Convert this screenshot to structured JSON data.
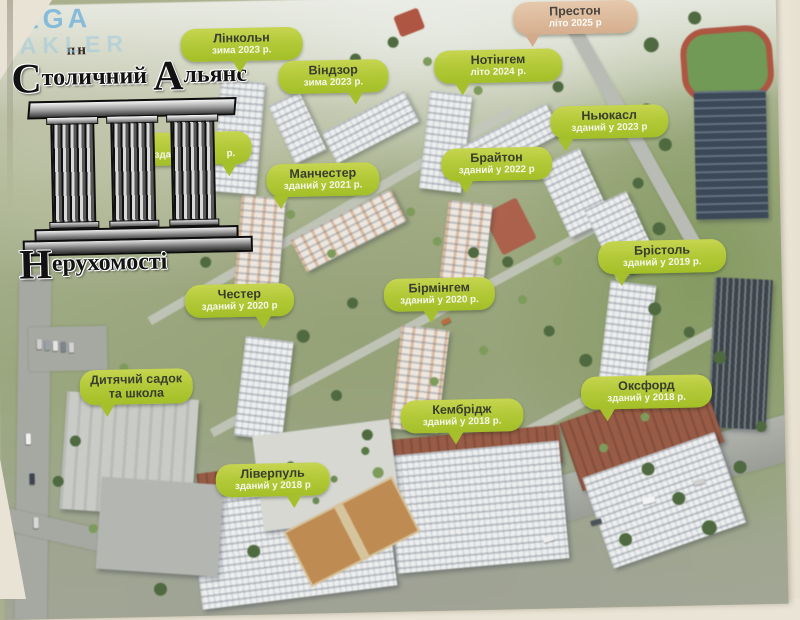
{
  "watermark": {
    "line1": "MEGA",
    "line2": "MAKLER"
  },
  "logo": {
    "top": "пн",
    "title_cap1": "С",
    "title_rest1": "толичний",
    "title_cap2": "А",
    "title_rest2": "льянс",
    "sub_cap": "Н",
    "sub_rest": "ерухомості"
  },
  "labels": [
    {
      "id": "london-partial",
      "title": "Ло",
      "date": "здани                р.",
      "variant": "green",
      "x": 143,
      "y": 130,
      "w": 102,
      "tail": 80,
      "behind_logo": true
    },
    {
      "id": "linkoln",
      "title": "Лінкольн",
      "date": "зима 2023 р.",
      "variant": "green",
      "x": 188,
      "y": 27,
      "w": 110,
      "tail": 48
    },
    {
      "id": "vindzor",
      "title": "Віндзор",
      "date": "зима 2023 р.",
      "variant": "green",
      "x": 285,
      "y": 61,
      "w": 98,
      "tail": 70
    },
    {
      "id": "notingem",
      "title": "Нотінгем",
      "date": "літо 2024 р.",
      "variant": "green",
      "x": 441,
      "y": 54,
      "w": 116,
      "tail": 22
    },
    {
      "id": "preston",
      "title": "Престон",
      "date": "літо 2025 р",
      "variant": "tan",
      "x": 521,
      "y": 7,
      "w": 112,
      "tail": 15
    },
    {
      "id": "nyukasl",
      "title": "Ньюкасл",
      "date": "зданий у 2023 р",
      "variant": "green",
      "x": 556,
      "y": 112,
      "w": 106,
      "tail": 13
    },
    {
      "id": "brayton",
      "title": "Брайтон",
      "date": "зданий у 2022 р",
      "variant": "green",
      "x": 446,
      "y": 152,
      "w": 99,
      "tail": 22
    },
    {
      "id": "manchester",
      "title": "Манчестер",
      "date": "зданий у 2021 р.",
      "variant": "green",
      "x": 271,
      "y": 164,
      "w": 101,
      "tail": 12
    },
    {
      "id": "chester",
      "title": "Честер",
      "date": "зданий у 2020 р",
      "variant": "green",
      "x": 187,
      "y": 283,
      "w": 97,
      "tail": 72
    },
    {
      "id": "birmingem",
      "title": "Бірмінгем",
      "date": "зданий у 2020 р.",
      "variant": "green",
      "x": 386,
      "y": 281,
      "w": 99,
      "tail": 42
    },
    {
      "id": "bristol",
      "title": "Брістоль",
      "date": "зданий у 2019 р.",
      "variant": "green",
      "x": 601,
      "y": 248,
      "w": 116,
      "tail": 18
    },
    {
      "id": "oksford",
      "title": "Оксфорд",
      "date": "зданий у 2018 р.",
      "variant": "green",
      "x": 581,
      "y": 383,
      "w": 119,
      "tail": 20
    },
    {
      "id": "kembridzh",
      "title": "Кембрідж",
      "date": "зданий у 2018 р.",
      "variant": "green",
      "x": 400,
      "y": 403,
      "w": 111,
      "tail": 45
    },
    {
      "id": "liverpul",
      "title": "Ліверпуль",
      "date": "зданий у 2018 р",
      "variant": "green",
      "x": 214,
      "y": 463,
      "w": 102,
      "tail": 68
    },
    {
      "id": "sadok-shkola",
      "title": "Дитячий садок",
      "title2": "та школа",
      "variant": "green",
      "x": 80,
      "y": 366,
      "w": 101,
      "tail": 24
    }
  ],
  "colors": {
    "label_green": "#b4ca39",
    "label_tan": "#d5ae8e",
    "label_title": "#383d2e",
    "label_date": "#f6f7ea",
    "wall": "#eae4d6",
    "watermark_blue": "#7ab5d8"
  }
}
